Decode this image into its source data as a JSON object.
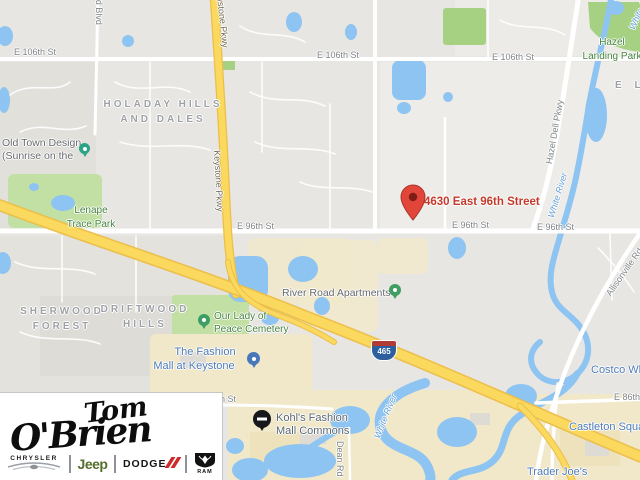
{
  "marker": {
    "label": "4630 East 96th Street"
  },
  "labels": {
    "streets": {
      "e106_a": "E 106th St",
      "e106_b": "E 106th St",
      "e106_c": "E 106th St",
      "e96_a": "E 96th St",
      "e96_b": "E 96th St",
      "e96_c": "E 96th St",
      "e86_a": "E 86th St",
      "e86_b": "E 86th St",
      "keystone": "Keystone Pkwy",
      "keystone_top": "Keystone Pkwy",
      "hazel_dell": "Hazel Dell Pkwy",
      "allisonville": "Allisonville Rd",
      "westfield": "Westfield Blvd",
      "dean": "Dean Rd"
    },
    "areas": {
      "holaday_1": "HOLADAY HILLS",
      "holaday_2": "AND DALES",
      "sherwood_1": "SHERWOOD",
      "sherwood_2": "FOREST",
      "driftwood_1": "DRIFTWOOD",
      "driftwood_2": "HILLS",
      "el_partial": "E L"
    },
    "parks": {
      "lenape_1": "Lenape",
      "lenape_2": "Trace Park",
      "hazel_landing_1": "Hazel",
      "hazel_landing_2": "Landing Park",
      "cemetery_1": "Our Lady of",
      "cemetery_2": "Peace Cemetery"
    },
    "water": {
      "white_river_a": "White River",
      "white_river_b": "White River",
      "white_river_c": "White River"
    },
    "pois": {
      "old_town_1": "Old Town Design",
      "old_town_2": "(Sunrise on the",
      "river_road": "River Road Apartments",
      "fashion_mall_1": "The Fashion",
      "fashion_mall_2": "Mall at Keystone",
      "kohls_1": "Kohl's Fashion",
      "kohls_2": "Mall Commons",
      "castleton": "Castleton Square",
      "trader_joes": "Trader Joe's",
      "costco": "Costco Wholesale"
    },
    "routes": {
      "i465": "465"
    }
  },
  "logo": {
    "dealer_line1": "Tom",
    "dealer_line2": "O'Brien",
    "brands": {
      "chrysler": "CHRYSLER",
      "jeep": "Jeep",
      "dodge": "DODGE",
      "ram": "RAM"
    }
  },
  "colors": {
    "land": "#e8e6e2",
    "water": "#8ec4f1",
    "park": "#c3e0a4",
    "park_dark": "#a6d182",
    "commercial": "#f1e8ca",
    "highway": "#fbd95e",
    "highway_casing": "#ecbe4a",
    "street_label": "#7e8388",
    "area_label": "#9da1a6",
    "park_label": "#45823e",
    "water_label": "#64a0d8",
    "poi_blue": "#4d7ab5",
    "poi_gray": "#66696d",
    "marker_red": "#e2453a",
    "marker_label": "#c5392b",
    "pin_green": "#3f9e63",
    "pin_teal": "#2aa387",
    "pin_blue": "#4878ba",
    "shield_blue": "#2d5f9e",
    "shield_red": "#b23b36",
    "jeep_green": "#54702c",
    "dodge_red": "#cf2a27"
  }
}
